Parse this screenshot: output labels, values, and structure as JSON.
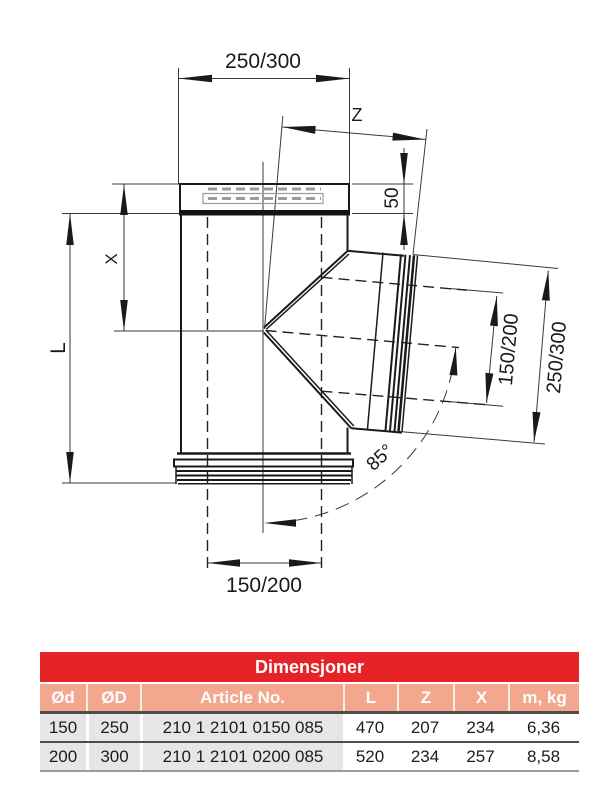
{
  "diagram": {
    "top_width_label": "250/300",
    "z_label": "Z",
    "socket_depth_label": "50",
    "x_label": "X",
    "length_label": "L",
    "branch_inner_label": "150/200",
    "branch_outer_label": "250/300",
    "angle_label": "85°",
    "bottom_inner_label": "150/200"
  },
  "table": {
    "title": "Dimensjoner",
    "columns": [
      "Ød",
      "ØD",
      "Article No.",
      "L",
      "Z",
      "X",
      "m, kg"
    ],
    "rows": [
      [
        "150",
        "250",
        "210 1 2101 0150 085",
        "470",
        "207",
        "234",
        "6,36"
      ],
      [
        "200",
        "300",
        "210 1 2101 0200 085",
        "520",
        "234",
        "257",
        "8,58"
      ]
    ]
  },
  "colors": {
    "header_red": "#e62428",
    "salmon": "#f3a78f",
    "gray_cell": "#e6e5e7",
    "line_dark": "#4d4d4d",
    "ink": "#1a1a1a"
  }
}
